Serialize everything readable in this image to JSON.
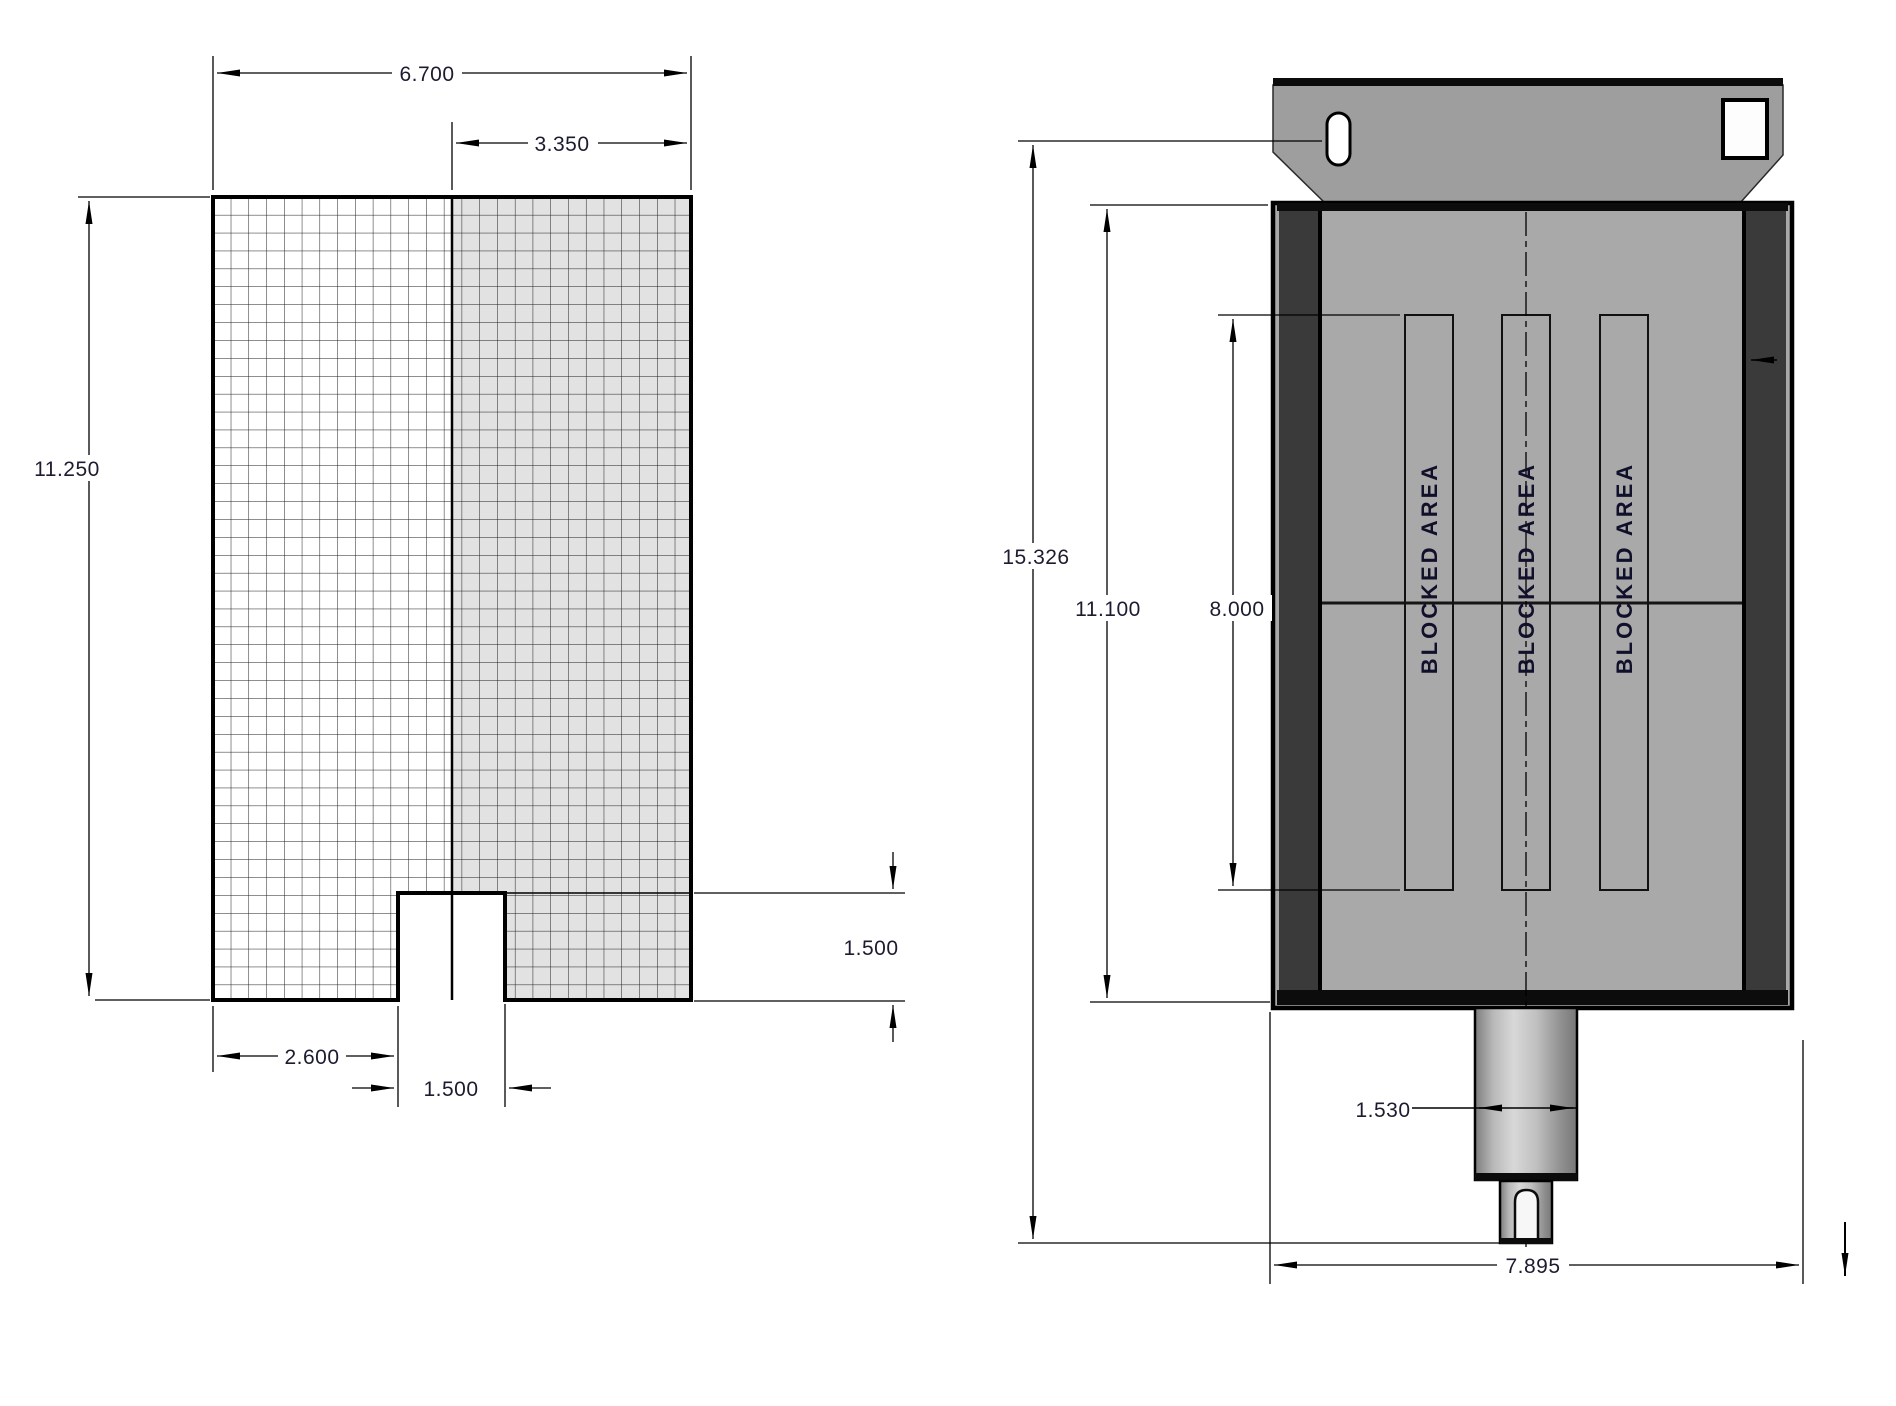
{
  "drawing": {
    "background_color": "#ffffff",
    "line_color": "#000000",
    "dim_text_color": "#1c1c30",
    "front_view": {
      "description": "grid plate front view with bottom slot",
      "grid_left_fill": "#ffffff",
      "grid_right_fill": "#e2e2e2",
      "dim_overall_width": "6.700",
      "dim_half_width": "3.350",
      "dim_overall_height": "11.250",
      "dim_slot_offset": "2.600",
      "dim_slot_width": "1.500",
      "dim_slot_depth": "1.500"
    },
    "side_view": {
      "description": "actuator body side view with mounting bracket and output shaft",
      "body_fill": "#a9a9a9",
      "rail_fill": "#3a3a3a",
      "bracket_fill": "#9e9e9e",
      "dim_overall_height": "15.326",
      "dim_body_height": "11.100",
      "dim_blocked_height": "8.000",
      "dim_shaft_diameter": "1.530",
      "dim_overall_width": "7.895",
      "blocked_area_label": "BLOCKED AREA"
    }
  }
}
